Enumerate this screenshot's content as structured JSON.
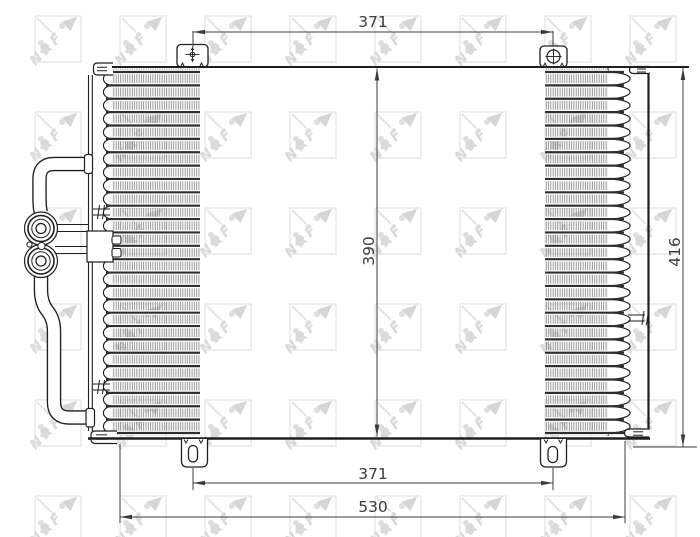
{
  "drawing": {
    "kind": "technical dimension drawing",
    "subject": "air-conditioning condenser, front view with serpentine fin core, side plates, mounting brackets and refrigerant pipes"
  },
  "watermark": {
    "label": "NRF"
  },
  "dimensions": {
    "top_width": {
      "label": "371"
    },
    "core_height": {
      "label": "390"
    },
    "overall_height": {
      "label": "416"
    },
    "bottom_width": {
      "label": "371"
    },
    "overall_width": {
      "label": "530"
    }
  },
  "colors": {
    "line": "#1f1f1f",
    "dimension": "#3c3c3c",
    "tube": "#2e2e2e",
    "fin": "#757575",
    "watermark": "#d6d6d6",
    "background": "#ffffff"
  }
}
